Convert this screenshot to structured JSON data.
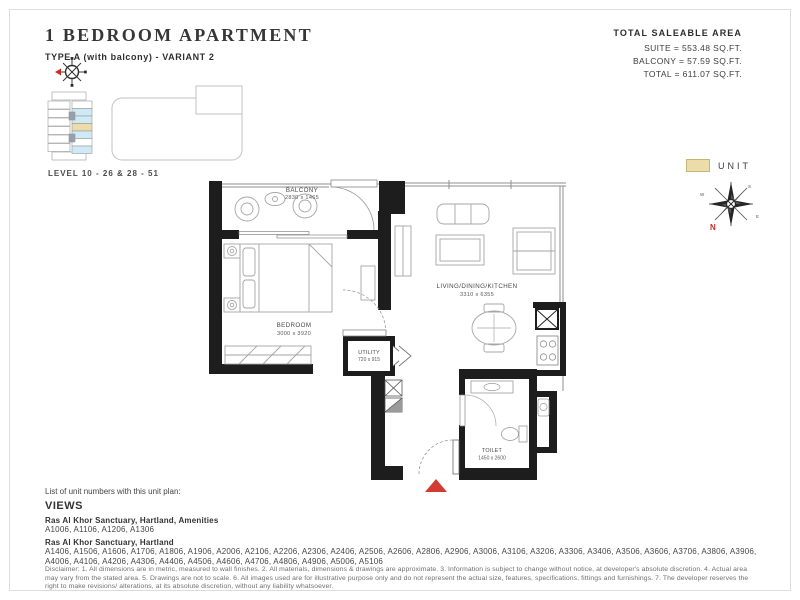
{
  "header": {
    "title": "1 BEDROOM APARTMENT",
    "subtitle": "TYPE A (with balcony) - VARIANT 2"
  },
  "area_summary": {
    "heading": "TOTAL SALEABLE AREA",
    "suite": "SUITE = 553.48 SQ.FT.",
    "balcony": "BALCONY = 57.59 SQ.FT.",
    "total": "TOTAL = 611.07 SQ.FT."
  },
  "key_plan": {
    "level_label": "LEVEL 10 - 26 & 28 - 51"
  },
  "legend": {
    "unit_label": "UNIT"
  },
  "compass": {
    "north_label": "N",
    "south_label": "S",
    "east_label": "E",
    "west_label": "W"
  },
  "plan": {
    "rooms": {
      "balcony": {
        "name": "BALCONY",
        "dims": "2830 x 1465"
      },
      "bedroom": {
        "name": "BEDROOM",
        "dims": "3000 x 3920"
      },
      "living": {
        "name": "LIVING/DINING/KITCHEN",
        "dims": "3310 x 6355"
      },
      "utility": {
        "name": "UTILITY",
        "dims": "720 x 915"
      },
      "toilet": {
        "name": "TOILET",
        "dims": "1450 x 2600"
      }
    }
  },
  "unit_list": {
    "intro": "List of unit numbers with this unit plan:",
    "views_heading": "VIEWS",
    "groups": [
      {
        "title": "Ras Al Khor Sanctuary, Hartland, Amenities",
        "units": "A1006, A1106, A1206, A1306"
      },
      {
        "title": "Ras Al Khor Sanctuary, Hartland",
        "units": "A1406, A1506, A1606, A1706, A1806, A1906, A2006, A2106, A2206, A2306, A2406, A2506, A2606, A2806, A2906, A3006, A3106, A3206, A3306, A3406, A3506, A3606, A3706, A3806, A3906, A4006, A4106, A4206, A4306, A4406, A4506, A4606, A4706, A4806, A4906, A5006, A5106"
      }
    ]
  },
  "disclaimer": "Disclaimer: 1. All dimensions are in metric, measured to wall finishes. 2. All materials, dimensions & drawings are approximate. 3. Information is subject to change without notice, at developer's absolute discretion. 4. Actual area may vary from the stated area. 5. Drawings are not to scale. 6. All images used are for illustrative purpose only and do not represent the actual size, features, specifications, fittings and furnishings. 7. The developer reserves the right to make revisions/ alterations, at its absolute discretion, without any liability whatsoever.",
  "colors": {
    "wall": "#1d1d1d",
    "accent_red": "#d23b31",
    "unit_highlight": "#ecdcaa",
    "keyplan_unit_blue": "#cfe9f5"
  }
}
